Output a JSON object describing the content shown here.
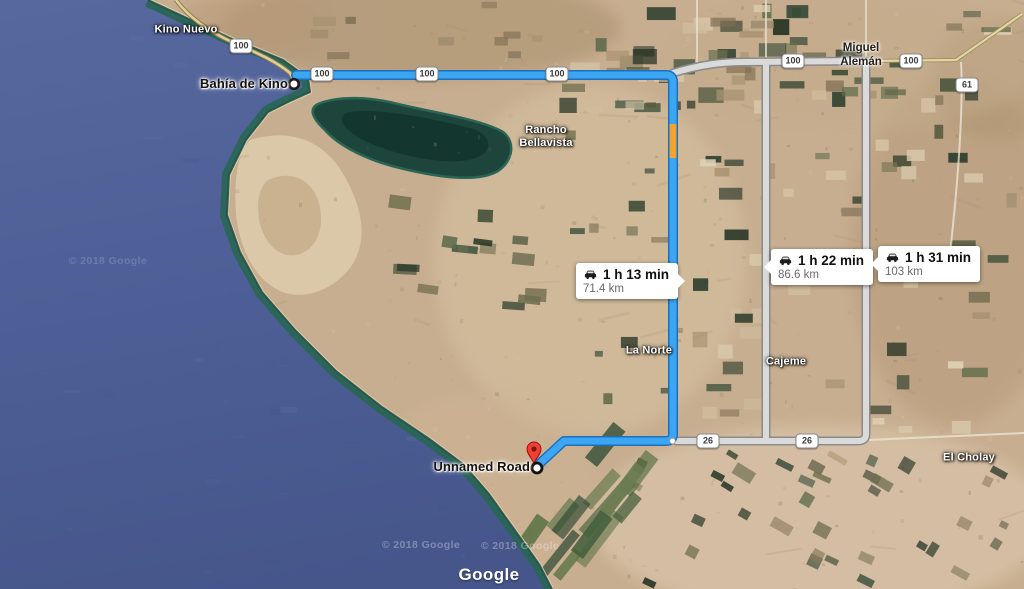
{
  "app": {
    "name": "Google Maps satellite route view"
  },
  "endpoints": {
    "origin": "Bahía de Kino",
    "destination": "Unnamed Road"
  },
  "routes": {
    "main": {
      "time": "1 h 13 min",
      "distance": "71.4 km",
      "color": "#3da6f2",
      "casing": "#1a6fbe",
      "traffic_color": "#f2a52e"
    },
    "alt1": {
      "time": "1 h 22 min",
      "distance": "86.6 km",
      "color": "#dadada",
      "casing": "#8a8a8a"
    },
    "alt2": {
      "time": "1 h 31 min",
      "distance": "103 km",
      "color": "#dadada",
      "casing": "#8a8a8a"
    }
  },
  "labels": [
    {
      "id": "kino-nuevo",
      "text": "Kino Nuevo",
      "x": 186,
      "y": 30,
      "style": "locality",
      "align": "center"
    },
    {
      "id": "bahia-de-kino",
      "text": "Bahía de Kino",
      "x": 288,
      "y": 84,
      "style": "town",
      "align": "right"
    },
    {
      "id": "rancho-bellavista",
      "text": "Rancho\nBellavista",
      "x": 546,
      "y": 137,
      "style": "locality",
      "align": "center"
    },
    {
      "id": "miguel-aleman",
      "text": "Miguel\nAlemán",
      "x": 861,
      "y": 56,
      "style": "town-small",
      "align": "center"
    },
    {
      "id": "la-norte",
      "text": "La Norte",
      "x": 649,
      "y": 351,
      "style": "locality",
      "align": "center"
    },
    {
      "id": "cajeme",
      "text": "Cajeme",
      "x": 786,
      "y": 362,
      "style": "locality",
      "align": "center"
    },
    {
      "id": "el-cholay",
      "text": "El Cholay",
      "x": 969,
      "y": 458,
      "style": "locality",
      "align": "center"
    },
    {
      "id": "unnamed-road",
      "text": "Unnamed Road",
      "x": 530,
      "y": 467,
      "style": "town",
      "align": "right"
    }
  ],
  "shields": [
    {
      "label": "100",
      "x": 241,
      "y": 46
    },
    {
      "label": "100",
      "x": 322,
      "y": 74
    },
    {
      "label": "100",
      "x": 427,
      "y": 74
    },
    {
      "label": "100",
      "x": 557,
      "y": 74
    },
    {
      "label": "100",
      "x": 793,
      "y": 61
    },
    {
      "label": "100",
      "x": 911,
      "y": 61
    },
    {
      "label": "61",
      "x": 967,
      "y": 85
    },
    {
      "label": "26",
      "x": 708,
      "y": 441
    },
    {
      "label": "26",
      "x": 807,
      "y": 441
    }
  ],
  "attribution": {
    "logo": "Google",
    "watermarks": [
      {
        "text": "© 2018 Google",
        "x": 108,
        "y": 261,
        "opacity": 0.16
      },
      {
        "text": "© 2018 Google",
        "x": 421,
        "y": 545,
        "opacity": 0.3
      },
      {
        "text": "© 2018 Google",
        "x": 520,
        "y": 546,
        "opacity": 0.3
      }
    ]
  }
}
